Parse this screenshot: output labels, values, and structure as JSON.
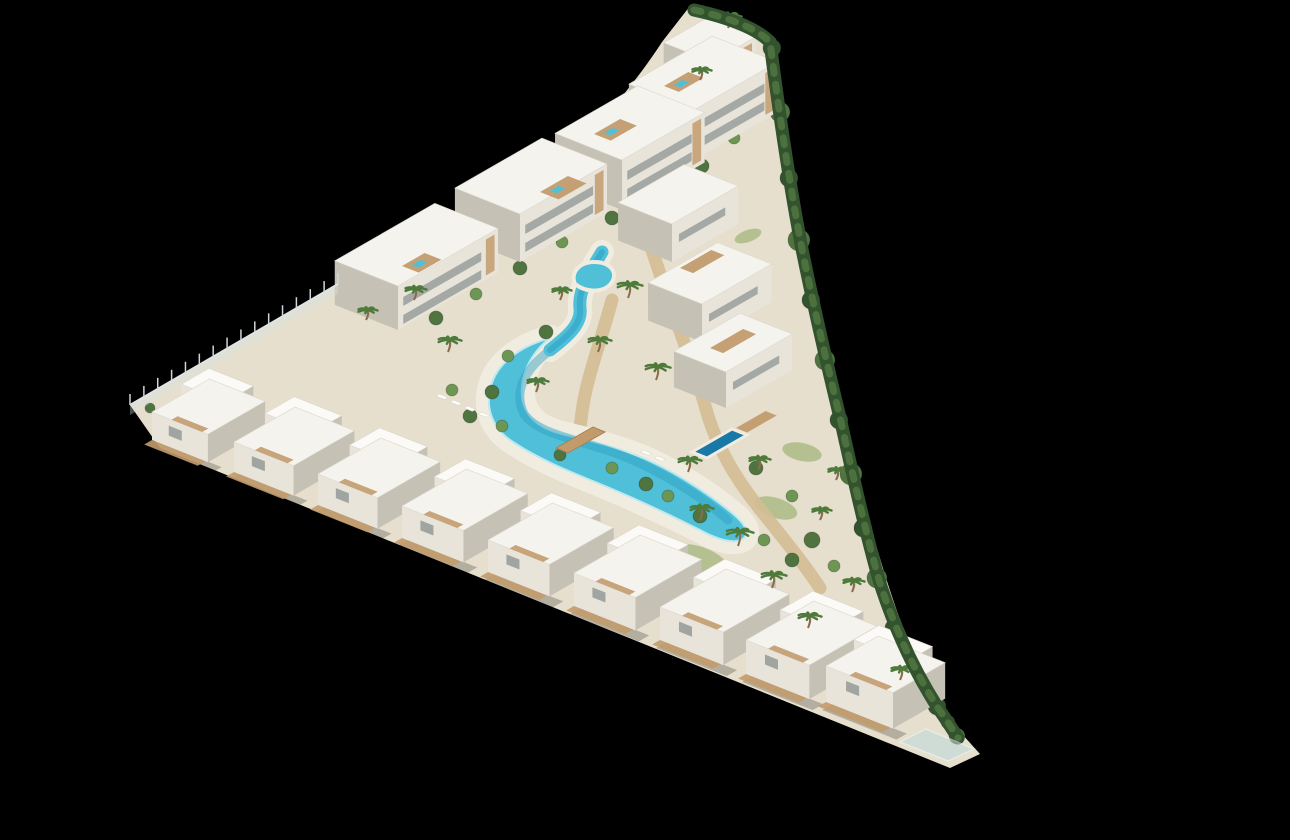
{
  "scene": {
    "type": "aerial-3d-architectural-render",
    "site_shape": "triangular-resort-plot-on-black",
    "features": [
      "apartment-blocks",
      "terraced-villas",
      "lagoon-pool",
      "wooden-bridge",
      "private-pools",
      "palm-garden",
      "perimeter-hedge",
      "boundary-fence"
    ]
  },
  "colors": {
    "background": "#000000",
    "ground": "#e7dfcd",
    "beach": "#f1ece0",
    "sand_path": "#d3bd95",
    "wood": "#c29b6d",
    "wood_dark": "#a87f52",
    "roof_white": "#f5f3ee",
    "roof_bright": "#fbfaf7",
    "roof_edge": "#dcd8cf",
    "wall_light": "#e8e4da",
    "wall_shadow": "#c6c1b5",
    "window_glass": "#939a98",
    "pool_main": "#4fc0d8",
    "pool_deep": "#2d9dc2",
    "pool_dark": "#1879a8",
    "green_dark": "#33522e",
    "green_mid": "#4f7440",
    "green_light": "#6d9553",
    "green_palm": "#4e7a3c",
    "trunk": "#8a6b4a",
    "grass": "#8aa65e",
    "lounger": "#fcfcf9"
  },
  "projection": {
    "u": [
      0.93,
      0.37
    ],
    "v": [
      0.87,
      -0.5
    ]
  },
  "paths": {
    "ground": "M 690 6 L 758 30 C 772 60 778 94 782 130 C 788 192 799 244 813 300 C 827 358 842 416 856 470 C 868 518 881 566 898 614 C 914 656 936 698 962 734 L 980 754 L 950 768 L 160 448 L 130 405 L 340 282 C 418 254 470 228 520 194 C 572 158 630 92 662 42 Z",
    "lagoon": "M 550 338 C 532 352 520 374 522 396 C 524 416 538 428 562 434 C 590 441 622 448 652 462 C 680 475 710 495 732 513 C 744 523 750 532 744 538 C 736 545 718 540 700 530 C 668 514 634 498 600 484 C 568 471 536 458 510 440 C 492 427 486 408 490 390 C 494 368 514 348 550 338 Z",
    "channel": "M 602 252 C 590 272 578 290 580 308 C 582 324 568 336 550 350",
    "pool_center": "M 548 352 C 522 372 514 394 524 414 C 536 432 570 438 606 450 C 644 462 694 490 728 520",
    "kidney": "M 575 284 C 570 272 580 262 594 262 C 610 262 618 272 612 282 C 606 292 588 294 575 284 Z",
    "private_pool": "M 692 452 L 732 429 L 747 435 L 707 458 Z",
    "bridge": "M 556 448 L 593 427 L 605 432 L 568 453 Z",
    "glass_terrace": "M 900 742 L 948 761 L 974 749 L 926 729 Z",
    "hedge": "M 694 10 C 730 18 756 28 770 42 C 780 120 790 186 801 244 C 813 304 827 364 841 422 C 853 476 865 530 879 580 C 895 630 915 672 938 708 C 948 722 954 732 958 738",
    "walkway": "M 212 408 C 380 474 560 540 740 602 C 830 634 880 656 906 676",
    "sand1": "M 648 238 C 672 312 696 372 708 416 C 718 448 734 476 756 504 C 778 532 800 558 820 588",
    "sand2": "M 612 300 C 600 344 586 380 582 412 C 580 428 578 438 578 446"
  },
  "villas": [
    [
      152,
      440,
      60,
      66,
      28
    ],
    [
      234,
      472,
      64,
      70,
      30
    ],
    [
      318,
      505,
      64,
      72,
      31
    ],
    [
      402,
      538,
      66,
      74,
      32
    ],
    [
      488,
      572,
      66,
      74,
      32
    ],
    [
      574,
      606,
      66,
      76,
      33
    ],
    [
      660,
      640,
      68,
      76,
      33
    ],
    [
      746,
      674,
      68,
      78,
      34
    ],
    [
      826,
      702,
      72,
      60,
      36
    ]
  ],
  "blocks": [
    [
      712,
      102,
      50,
      52,
      40
    ],
    [
      694,
      160,
      96,
      70,
      50
    ],
    [
      622,
      210,
      95,
      72,
      50
    ],
    [
      520,
      262,
      100,
      70,
      48
    ],
    [
      398,
      330,
      115,
      68,
      44
    ]
  ],
  "terraces": [
    [
      672,
      262,
      76,
      58,
      38
    ],
    [
      702,
      342,
      80,
      58,
      38
    ],
    [
      726,
      408,
      76,
      56,
      36
    ]
  ],
  "roof_decks": [
    [
      402,
      266,
      26,
      18
    ],
    [
      540,
      192,
      32,
      20
    ],
    [
      594,
      134,
      30,
      18
    ],
    [
      664,
      86,
      28,
      16
    ]
  ],
  "terrace_decks": [
    [
      680,
      268,
      36,
      14
    ],
    [
      710,
      348,
      38,
      14
    ],
    [
      736,
      428,
      34,
      12
    ]
  ],
  "grass": [
    [
      700,
      560,
      30,
      13,
      20
    ],
    [
      776,
      508,
      22,
      10,
      18
    ],
    [
      802,
      452,
      20,
      9,
      12
    ],
    [
      688,
      178,
      16,
      7,
      -28
    ],
    [
      748,
      236,
      14,
      6,
      -20
    ]
  ],
  "palms": [
    [
      628,
      298,
      13
    ],
    [
      598,
      352,
      12
    ],
    [
      656,
      380,
      13
    ],
    [
      536,
      392,
      11
    ],
    [
      688,
      472,
      12
    ],
    [
      738,
      546,
      14
    ],
    [
      772,
      588,
      13
    ],
    [
      808,
      628,
      12
    ],
    [
      448,
      352,
      12
    ],
    [
      414,
      300,
      11
    ],
    [
      366,
      320,
      10
    ],
    [
      560,
      300,
      10
    ],
    [
      758,
      470,
      11
    ],
    [
      700,
      520,
      12
    ],
    [
      820,
      520,
      10
    ],
    [
      852,
      592,
      11
    ],
    [
      728,
      28,
      12
    ],
    [
      700,
      80,
      10
    ],
    [
      900,
      680,
      11
    ],
    [
      836,
      480,
      10
    ]
  ],
  "bushes": [
    [
      772,
      48,
      9,
      0
    ],
    [
      780,
      112,
      10,
      1
    ],
    [
      789,
      178,
      9,
      0
    ],
    [
      799,
      240,
      11,
      1
    ],
    [
      811,
      300,
      9,
      0
    ],
    [
      825,
      360,
      10,
      1
    ],
    [
      839,
      420,
      9,
      0
    ],
    [
      851,
      474,
      11,
      1
    ],
    [
      863,
      528,
      9,
      0
    ],
    [
      877,
      578,
      10,
      1
    ],
    [
      894,
      628,
      9,
      0
    ],
    [
      914,
      670,
      10,
      1
    ],
    [
      937,
      706,
      9,
      0
    ],
    [
      957,
      736,
      8,
      1
    ],
    [
      436,
      318,
      7,
      1
    ],
    [
      476,
      294,
      6,
      2
    ],
    [
      520,
      268,
      7,
      1
    ],
    [
      562,
      242,
      6,
      2
    ],
    [
      612,
      218,
      7,
      1
    ],
    [
      656,
      192,
      6,
      2
    ],
    [
      702,
      166,
      7,
      1
    ],
    [
      734,
      138,
      6,
      2
    ],
    [
      546,
      332,
      7,
      1
    ],
    [
      508,
      356,
      6,
      2
    ],
    [
      492,
      392,
      7,
      1
    ],
    [
      502,
      426,
      6,
      2
    ],
    [
      470,
      416,
      7,
      1
    ],
    [
      452,
      390,
      6,
      2
    ],
    [
      560,
      455,
      6,
      1
    ],
    [
      612,
      468,
      6,
      2
    ],
    [
      646,
      484,
      7,
      1
    ],
    [
      668,
      496,
      6,
      2
    ],
    [
      700,
      516,
      7,
      1
    ],
    [
      262,
      420,
      6,
      1
    ],
    [
      342,
      452,
      7,
      2
    ],
    [
      422,
      484,
      6,
      1
    ],
    [
      502,
      516,
      7,
      2
    ],
    [
      582,
      548,
      6,
      1
    ],
    [
      662,
      580,
      7,
      2
    ],
    [
      742,
      612,
      6,
      1
    ],
    [
      822,
      644,
      7,
      2
    ],
    [
      872,
      664,
      6,
      1
    ],
    [
      756,
      468,
      7,
      1
    ],
    [
      792,
      496,
      6,
      2
    ],
    [
      812,
      540,
      8,
      1
    ],
    [
      834,
      566,
      6,
      2
    ],
    [
      792,
      560,
      7,
      1
    ],
    [
      764,
      540,
      6,
      2
    ],
    [
      150,
      408,
      5,
      1
    ],
    [
      742,
      60,
      7,
      0
    ],
    [
      756,
      92,
      6,
      1
    ],
    [
      948,
      722,
      7,
      0
    ],
    [
      930,
      700,
      6,
      1
    ]
  ],
  "loungers": [
    [
      436,
      396
    ],
    [
      450,
      402
    ],
    [
      464,
      408
    ],
    [
      478,
      414
    ],
    [
      640,
      452
    ],
    [
      654,
      458
    ]
  ],
  "fence": {
    "x1": 130,
    "y1": 405,
    "x2": 338,
    "y2": 284,
    "posts": 15,
    "height": 11
  }
}
